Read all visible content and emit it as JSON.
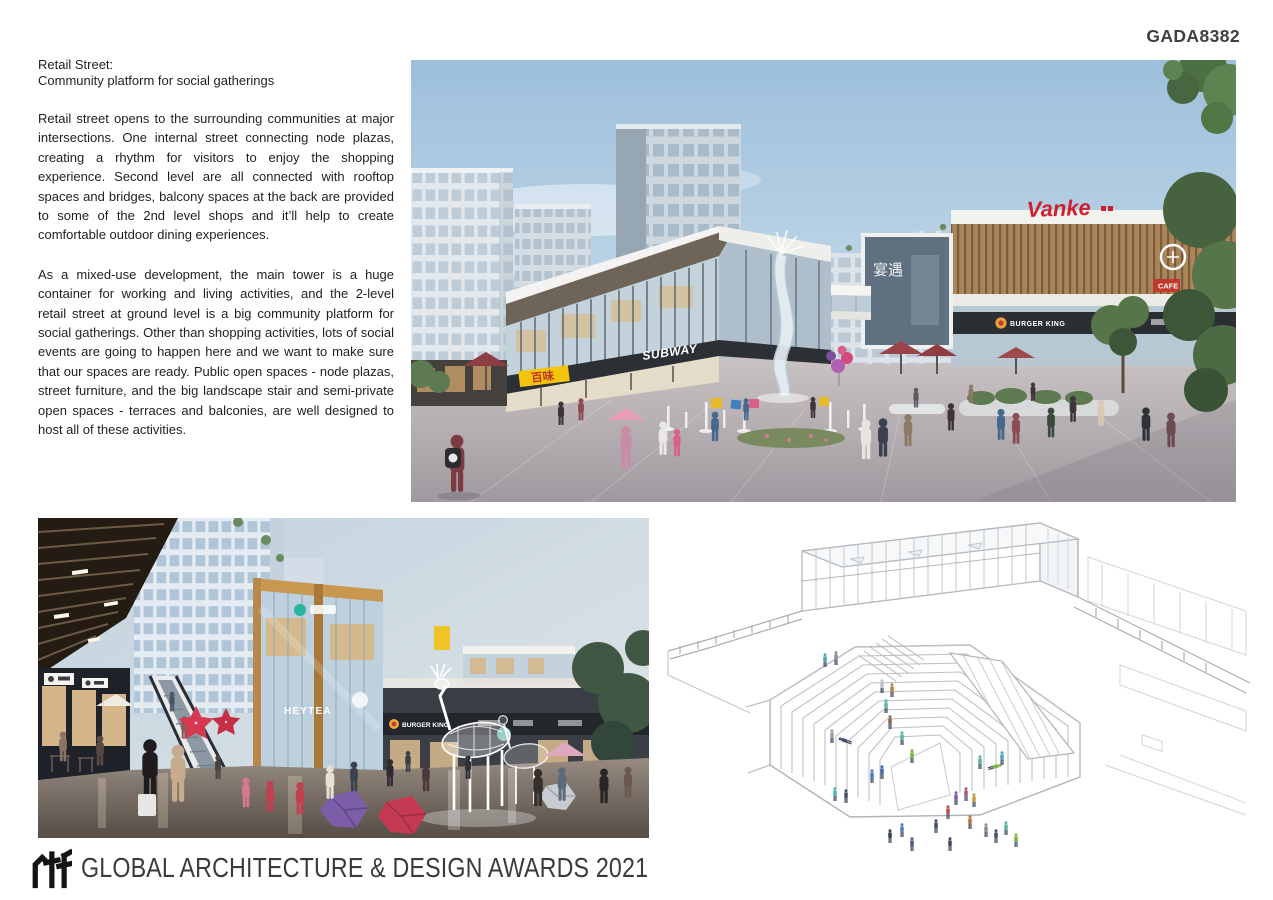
{
  "page": {
    "code": "GADA8382"
  },
  "article": {
    "title_line1": "Retail Street:",
    "title_line2": "Community platform for social gatherings",
    "paragraph1": "Retail street opens to the surrounding communities at major intersections. One internal street connecting node plazas, creating a rhythm for visitors to enjoy the shopping experience. Second level are all connected with rooftop spaces and bridges, balcony spaces at the back are provided to some of the 2nd level shops and it’ll help to create comfortable outdoor dining experiences.",
    "paragraph2": "As a mixed-use development, the main tower is a huge container for working and living activities, and the 2-level retail street at ground level is a big community platform for social gatherings. Other than shopping activities, lots of social events are going to happen here and we want to make sure that our spaces are ready. Public open spaces - node plazas, street furniture, and the big landscape stair and semi-private open spaces - terraces and balconies, are well designed to host all of these activities."
  },
  "renders": {
    "main": {
      "description": "Daytime rendering of the two-level retail street plaza with fountain, shoppers and mixed-use towers",
      "signs": {
        "vanke": "Vanke",
        "subway": "SUBWAY",
        "burger_king": "BURGER KING",
        "cafe": "CAFE",
        "noodle_shop": "百味",
        "banquet": "宴遇"
      }
    },
    "night": {
      "description": "Dusk rendering of the retail street with escalator, illuminated deer sculpture and shoppers",
      "signs": {
        "heytea": "HEYTEA",
        "burger_king": "BURGER KING"
      }
    },
    "axon": {
      "description": "Axonometric line drawing of the sunken landscape stair plaza with people"
    }
  },
  "footer": {
    "logo": "rtf",
    "title": "GLOBAL ARCHITECTURE & DESIGN AWARDS 2021"
  },
  "colors": {
    "accent_red": "#d02030",
    "star_red": "#d63850",
    "subway_yellow": "#f5c50a",
    "sign_yellow": "#f3c50a",
    "sky_blue": "#a5c4de",
    "text_dark": "#1f1f1f"
  }
}
